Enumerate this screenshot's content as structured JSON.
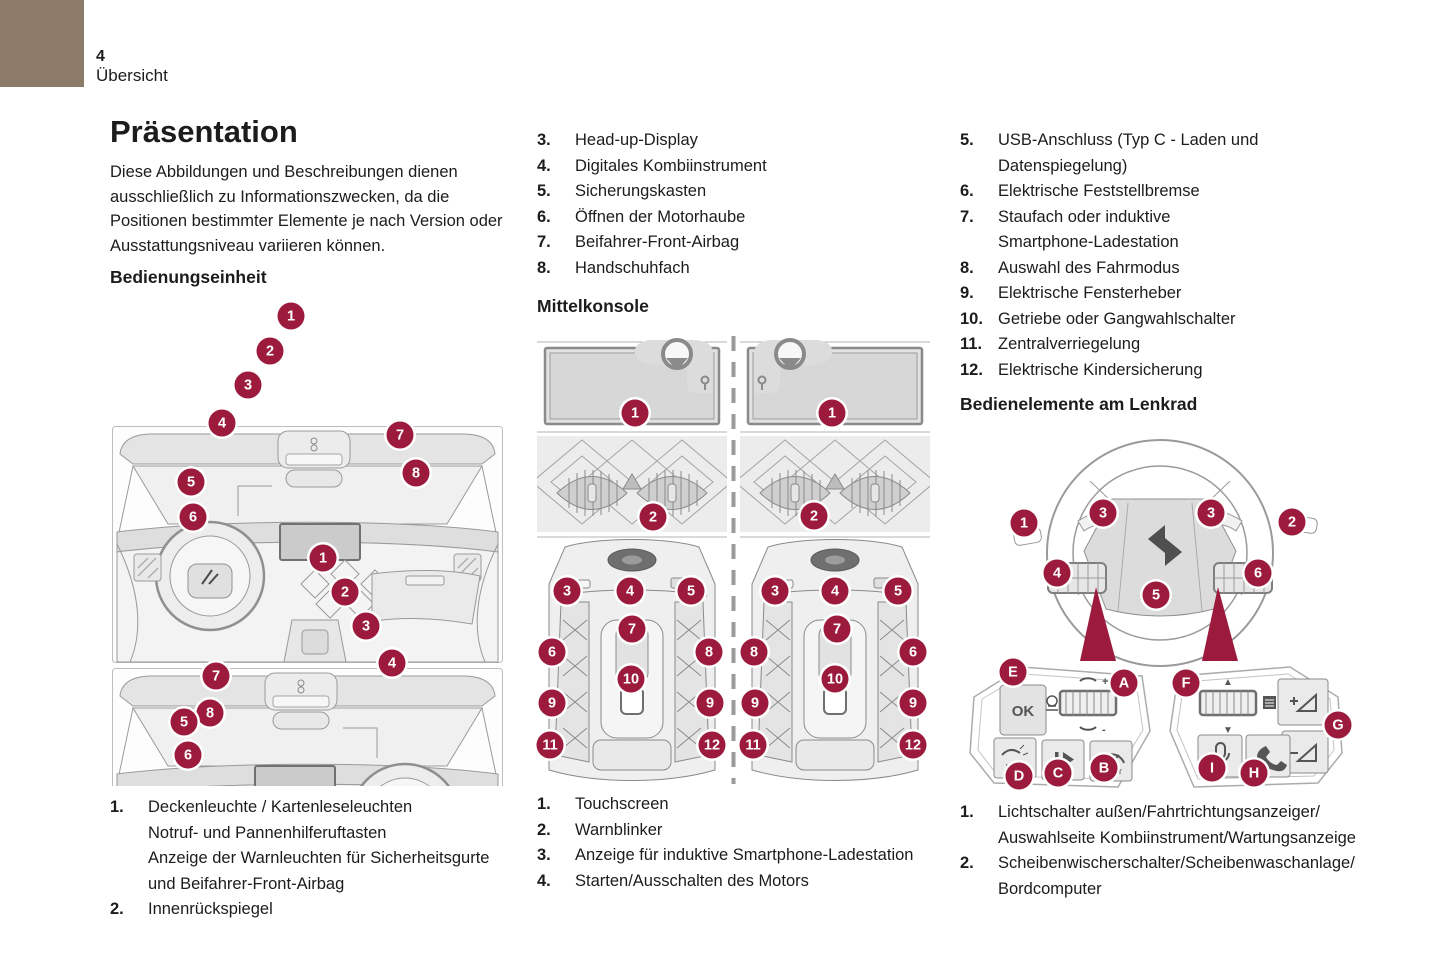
{
  "colors": {
    "accent": "#9c1b3d",
    "corner": "#8c7b69"
  },
  "header": {
    "page_number": "4",
    "section": "Übersicht"
  },
  "col1": {
    "title": "Präsentation",
    "intro": "Diese Abbildungen und Beschreibungen dienen ausschließlich zu Informationszwecken, da die Positionen bestimmter Elemente je nach Version oder Ausstattungsniveau variieren können.",
    "heading": "Bedienungseinheit",
    "legend": [
      {
        "n": "1.",
        "lines": [
          "Deckenleuchte / Kartenleseleuchten",
          "Notruf- und Pannenhilferuftasten",
          "Anzeige der Warnleuchten für Sicherheitsgurte",
          "und Beifahrer-Front-Airbag"
        ]
      },
      {
        "n": "2.",
        "lines": [
          "Innenrückspiegel"
        ]
      }
    ],
    "callouts": [
      {
        "t": "1",
        "x": 181,
        "y": 13
      },
      {
        "t": "2",
        "x": 160,
        "y": 48
      },
      {
        "t": "3",
        "x": 138,
        "y": 82
      },
      {
        "t": "4",
        "x": 112,
        "y": 120
      },
      {
        "t": "7",
        "x": 290,
        "y": 132
      },
      {
        "t": "8",
        "x": 306,
        "y": 170
      },
      {
        "t": "5",
        "x": 81,
        "y": 179
      },
      {
        "t": "6",
        "x": 83,
        "y": 214
      },
      {
        "t": "1",
        "x": 213,
        "y": 255
      },
      {
        "t": "2",
        "x": 235,
        "y": 289
      },
      {
        "t": "3",
        "x": 256,
        "y": 323
      },
      {
        "t": "4",
        "x": 282,
        "y": 360
      },
      {
        "t": "7",
        "x": 106,
        "y": 373
      },
      {
        "t": "8",
        "x": 100,
        "y": 410
      },
      {
        "t": "5",
        "x": 74,
        "y": 419
      },
      {
        "t": "6",
        "x": 78,
        "y": 452
      }
    ]
  },
  "col2": {
    "list": [
      {
        "n": "3.",
        "lines": [
          "Head-up-Display"
        ]
      },
      {
        "n": "4.",
        "lines": [
          "Digitales Kombiinstrument"
        ]
      },
      {
        "n": "5.",
        "lines": [
          "Sicherungskasten"
        ]
      },
      {
        "n": "6.",
        "lines": [
          "Öffnen der Motorhaube"
        ]
      },
      {
        "n": "7.",
        "lines": [
          "Beifahrer-Front-Airbag"
        ]
      },
      {
        "n": "8.",
        "lines": [
          "Handschuhfach"
        ]
      }
    ],
    "heading": "Mittelkonsole",
    "legend": [
      {
        "n": "1.",
        "lines": [
          "Touchscreen"
        ]
      },
      {
        "n": "2.",
        "lines": [
          "Warnblinker"
        ]
      },
      {
        "n": "3.",
        "lines": [
          "Anzeige für induktive Smartphone-Ladestation"
        ]
      },
      {
        "n": "4.",
        "lines": [
          "Starten/Ausschalten des Motors"
        ]
      }
    ],
    "callouts": [
      {
        "t": "1",
        "x": 98,
        "y": 81
      },
      {
        "t": "1",
        "x": 295,
        "y": 81
      },
      {
        "t": "2",
        "x": 116,
        "y": 185
      },
      {
        "t": "2",
        "x": 277,
        "y": 184
      },
      {
        "t": "3",
        "x": 30,
        "y": 259
      },
      {
        "t": "4",
        "x": 93,
        "y": 259
      },
      {
        "t": "5",
        "x": 154,
        "y": 259
      },
      {
        "t": "7",
        "x": 95,
        "y": 297
      },
      {
        "t": "6",
        "x": 15,
        "y": 320
      },
      {
        "t": "8",
        "x": 172,
        "y": 320
      },
      {
        "t": "10",
        "x": 94,
        "y": 347
      },
      {
        "t": "9",
        "x": 15,
        "y": 371
      },
      {
        "t": "9",
        "x": 173,
        "y": 371
      },
      {
        "t": "11",
        "x": 13,
        "y": 413
      },
      {
        "t": "12",
        "x": 175,
        "y": 413
      },
      {
        "t": "3",
        "x": 238,
        "y": 259
      },
      {
        "t": "4",
        "x": 298,
        "y": 259
      },
      {
        "t": "5",
        "x": 361,
        "y": 259
      },
      {
        "t": "7",
        "x": 300,
        "y": 297
      },
      {
        "t": "8",
        "x": 217,
        "y": 320
      },
      {
        "t": "6",
        "x": 376,
        "y": 320
      },
      {
        "t": "10",
        "x": 298,
        "y": 347
      },
      {
        "t": "9",
        "x": 218,
        "y": 371
      },
      {
        "t": "9",
        "x": 376,
        "y": 371
      },
      {
        "t": "11",
        "x": 216,
        "y": 413
      },
      {
        "t": "12",
        "x": 376,
        "y": 413
      }
    ]
  },
  "col3": {
    "list": [
      {
        "n": "5.",
        "lines": [
          "USB-Anschluss (Typ C - Laden und",
          "Datenspiegelung)"
        ]
      },
      {
        "n": "6.",
        "lines": [
          "Elektrische Feststellbremse"
        ]
      },
      {
        "n": "7.",
        "lines": [
          "Staufach oder induktive",
          "Smartphone-Ladestation"
        ]
      },
      {
        "n": "8.",
        "lines": [
          "Auswahl des Fahrmodus"
        ]
      },
      {
        "n": "9.",
        "lines": [
          "Elektrische Fensterheber"
        ]
      },
      {
        "n": "10.",
        "lines": [
          "Getriebe oder Gangwahlschalter"
        ]
      },
      {
        "n": "11.",
        "lines": [
          "Zentralverriegelung"
        ]
      },
      {
        "n": "12.",
        "lines": [
          "Elektrische Kindersicherung"
        ]
      }
    ],
    "heading": "Bedienelemente am Lenkrad",
    "legend": [
      {
        "n": "1.",
        "lines": [
          "Lichtschalter außen/Fahrtrichtungsanzeiger/",
          "Auswahlseite Kombiinstrument/Wartungsanzeige"
        ]
      },
      {
        "n": "2.",
        "lines": [
          "Scheibenwischerschalter/Scheibenwaschanlage/",
          "Bordcomputer"
        ]
      }
    ],
    "callouts": [
      {
        "t": "1",
        "x": 64,
        "y": 88
      },
      {
        "t": "3",
        "x": 143,
        "y": 78
      },
      {
        "t": "3",
        "x": 251,
        "y": 78
      },
      {
        "t": "2",
        "x": 332,
        "y": 87
      },
      {
        "t": "4",
        "x": 97,
        "y": 138
      },
      {
        "t": "6",
        "x": 298,
        "y": 138
      },
      {
        "t": "5",
        "x": 196,
        "y": 160
      },
      {
        "t": "E",
        "x": 53,
        "y": 237
      },
      {
        "t": "A",
        "x": 164,
        "y": 248
      },
      {
        "t": "F",
        "x": 226,
        "y": 248
      },
      {
        "t": "G",
        "x": 378,
        "y": 290
      },
      {
        "t": "D",
        "x": 59,
        "y": 341
      },
      {
        "t": "C",
        "x": 98,
        "y": 338
      },
      {
        "t": "B",
        "x": 144,
        "y": 333
      },
      {
        "t": "I",
        "x": 252,
        "y": 333
      },
      {
        "t": "H",
        "x": 294,
        "y": 338
      }
    ]
  },
  "icons": {
    "ok": "OK",
    "plus": "+",
    "minus": "-",
    "up": "▲",
    "down": "▼",
    "limit": "LIMIT",
    "assist": "ASSIST"
  }
}
